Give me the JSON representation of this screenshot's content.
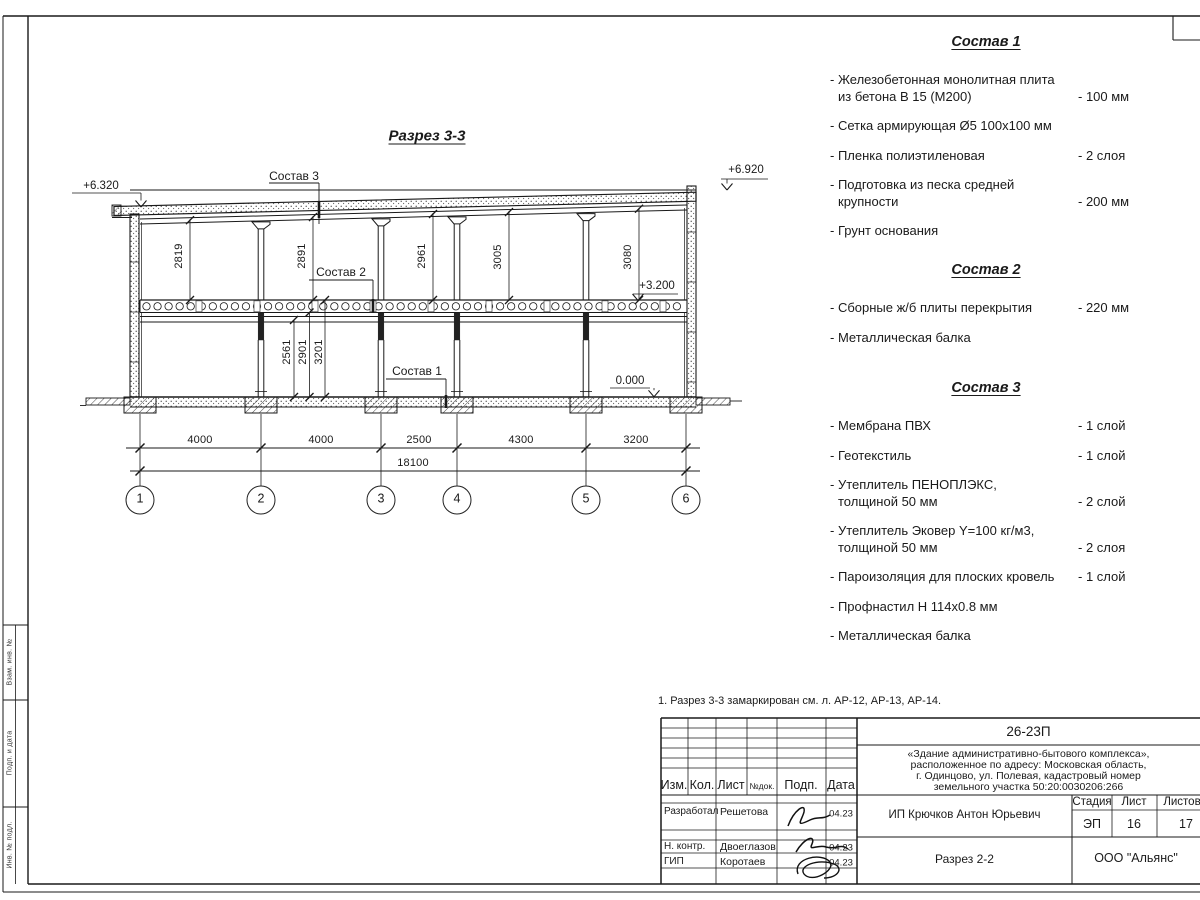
{
  "frame": {
    "stamp_labels": [
      "Взам. инв. №",
      "Подп. и дата",
      "Инв. № подл."
    ]
  },
  "drawing": {
    "title": "Разрез 3-3",
    "elevations": [
      "+6.320",
      "+6.920",
      "+3.200",
      "0.000"
    ],
    "leaders": [
      "Состав 3",
      "Состав 2",
      "Состав 1"
    ],
    "upper_dims": [
      "2819",
      "2891",
      "2961",
      "3005",
      "3080"
    ],
    "lower_dims": [
      "2561",
      "2901",
      "3201"
    ],
    "span_dims": [
      "4000",
      "4000",
      "2500",
      "4300",
      "3200"
    ],
    "total_dim": "18100",
    "axes": [
      "1",
      "2",
      "3",
      "4",
      "5",
      "6"
    ]
  },
  "specs": [
    {
      "title": "Состав 1",
      "items": [
        {
          "line1": "- Железобетонная  монолитная плита",
          "line2": "из бетона В 15 (М200)",
          "value": "- 100 мм"
        },
        {
          "line1": "- Сетка армирующая Ø5 100х100 мм",
          "line2": "",
          "value": ""
        },
        {
          "line1": "- Пленка полиэтиленовая",
          "line2": "",
          "value": "-  2 слоя"
        },
        {
          "line1": "- Подготовка из песка средней",
          "line2": "крупности",
          "value": "- 200 мм"
        },
        {
          "line1": "- Грунт основания",
          "line2": "",
          "value": ""
        }
      ]
    },
    {
      "title": "Состав 2",
      "items": [
        {
          "line1": "- Сборные ж/б плиты перекрытия",
          "line2": "",
          "value": "- 220 мм"
        },
        {
          "line1": "- Металлическая балка",
          "line2": "",
          "value": ""
        }
      ]
    },
    {
      "title": "Состав 3",
      "items": [
        {
          "line1": "- Мембрана ПВХ",
          "line2": "",
          "value": "- 1 слой"
        },
        {
          "line1": "- Геотекстиль",
          "line2": "",
          "value": "- 1 слой"
        },
        {
          "line1": "- Утеплитель ПЕНОПЛЭКС,",
          "line2": "толщиной 50 мм",
          "value": "- 2 слой"
        },
        {
          "line1": "- Утеплитель Эковер Y=100 кг/м3,",
          "line2": "толщиной 50 мм",
          "value": "- 2 слоя"
        },
        {
          "line1": "- Пароизоляция для плоских кровель",
          "line2": "",
          "value": "- 1 слой"
        },
        {
          "line1": "- Профнастил Н 114х0.8 мм",
          "line2": "",
          "value": ""
        },
        {
          "line1": "- Металлическая балка",
          "line2": "",
          "value": ""
        }
      ]
    }
  ],
  "note": "1. Разрез 3-3 замаркирован см. л. АР-12, АР-13, АР-14.",
  "titleblock": {
    "doc_number": "26-23П",
    "project_lines": [
      "«Здание административно-бытового комплекса»,",
      "расположенное по адресу: Московская область,",
      "г. Одинцово, ул. Полевая, кадастровый номер",
      "земельного участка 50:20:0030206:266"
    ],
    "rev_headers": [
      "Изм.",
      "Кол.",
      "Лист",
      "№док.",
      "Подп.",
      "Дата"
    ],
    "people": [
      {
        "role": "Разработал",
        "name": "Решетова",
        "date": "04.23"
      },
      {
        "role": "Н. контр.",
        "name": "Двоеглазов",
        "date": "04.23"
      },
      {
        "role": "ГИП",
        "name": "Коротаев",
        "date": "04.23"
      }
    ],
    "client": "ИП Крючков Антон Юрьевич",
    "stage_header": "Стадия",
    "sheet_header": "Лист",
    "sheets_header": "Листов",
    "stage": "ЭП",
    "sheet": "16",
    "sheets": "17",
    "drawing_name": "Разрез 2-2",
    "company": "ООО \"Альянс\""
  }
}
